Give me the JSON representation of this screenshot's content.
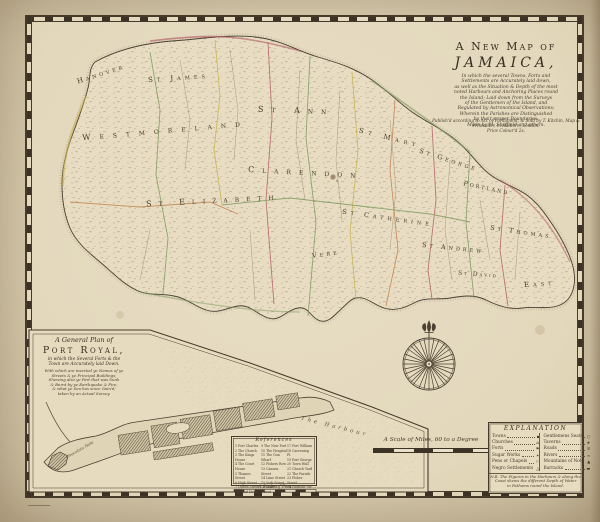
{
  "title": {
    "line1": "A New Map of",
    "line2": "JAMAICA,",
    "paragraph": "In which the several Towns, Forts and\nSettlements are Accurately laid down,\nas well as the Situation & Depth of the most\nnoted Harbours and Anchoring Places round\nthe Island; Laid down from the Surveys\nof the Gentlemen of the Island, and\nRegulated by Astronomical Observations;\nWherein the Parishes are Distinguished\nby their proper Boundaries.\nMade by M. Sheffield and others."
  },
  "imprint": "Publish'd according to Act of Parliament, & Sold by T. Kitchin, Map & Printseller, in Holborn, London.\nPrice Colour'd 2s.",
  "map": {
    "parishes": [
      {
        "name": "Hanover"
      },
      {
        "name": "St James"
      },
      {
        "name": "Westmoreland"
      },
      {
        "name": "St Elizabeth"
      },
      {
        "name": "St Ann"
      },
      {
        "name": "St Mary"
      },
      {
        "name": "Clarendon"
      },
      {
        "name": "St George"
      },
      {
        "name": "Portland"
      },
      {
        "name": "St Catherine"
      },
      {
        "name": "St Andrew"
      },
      {
        "name": "St David"
      },
      {
        "name": "St Thomas"
      },
      {
        "name": "East"
      },
      {
        "name": "Vere"
      }
    ]
  },
  "scale_miles": {
    "label": "A Scale of Miles, 60 to a Degree"
  },
  "explanation": {
    "title": "EXPLANATION",
    "left": [
      {
        "label": "Towns",
        "sym": "▪"
      },
      {
        "label": "Churches",
        "sym": "⌂"
      },
      {
        "label": "Forts",
        "sym": "⚑"
      },
      {
        "label": "Sugar Works",
        "sym": "✶"
      },
      {
        "label": "Pens or Chapels",
        "sym": "⚐"
      },
      {
        "label": "Negro Settlements",
        "sym": "△"
      }
    ],
    "right": [
      {
        "label": "Gentlemens Seats",
        "sym": "○"
      },
      {
        "label": "Taverns",
        "sym": "★"
      },
      {
        "label": "Roads",
        "sym": "≡"
      },
      {
        "label": "Rivers",
        "sym": "≈"
      },
      {
        "label": "Mountains of Note",
        "sym": "▲"
      },
      {
        "label": "Barracks",
        "sym": "▬"
      }
    ],
    "note": "N.B. The Figures in the Harbours & along the\nCoast shews the different Depth of Water\nin Fathoms round the Island."
  },
  "inset": {
    "title1": "A General Plan of",
    "title2": "Port Royal,",
    "subtitle": "in which the Several Forts & the\nTown are Accurately laid Down.",
    "paragraph": "With which are inserted ye Names of ye\nStreets & ye Principal Buildings;\nShewing also ye Part that was Sunk\n& Burnt by ye Earthquake & Fire,\n& what ye Sea has since Gain'd;\ntaken by an Actual Survey.",
    "references_title": "References",
    "ref_col1": "1 Fort Charles\n2 The Church\n3 The Kings House\n4 The Court House\n5 Thames Street\n6 High Street\n7 Queen Street\n8 Broad Street",
    "ref_col2": "9 The New Fort\n10 The Hospital\n11 The Gun Wharf\n12 Fishers Row\n13 Cannon Street\n14 Lime Street\n15 York Street\n16 Tower Street",
    "ref_col3": "17 Fort William\n18 Careening Pl.\n19 Fort George\n20 Town Wall\n21 Church Yard\n22 The Parade\n23 Fisher Street\n24 Harbour Str.",
    "scale_label": "A Scale of Feet",
    "harbour_label": "The  Harbour",
    "hole_label": "Chocolata Hole"
  },
  "colors": {
    "paper": "#e3d8bc",
    "ink": "#43392a",
    "boundary_green": "#7f9a5f",
    "boundary_orange": "#c3824e",
    "boundary_red": "#b5606a",
    "boundary_yellow": "#c8b34e"
  }
}
